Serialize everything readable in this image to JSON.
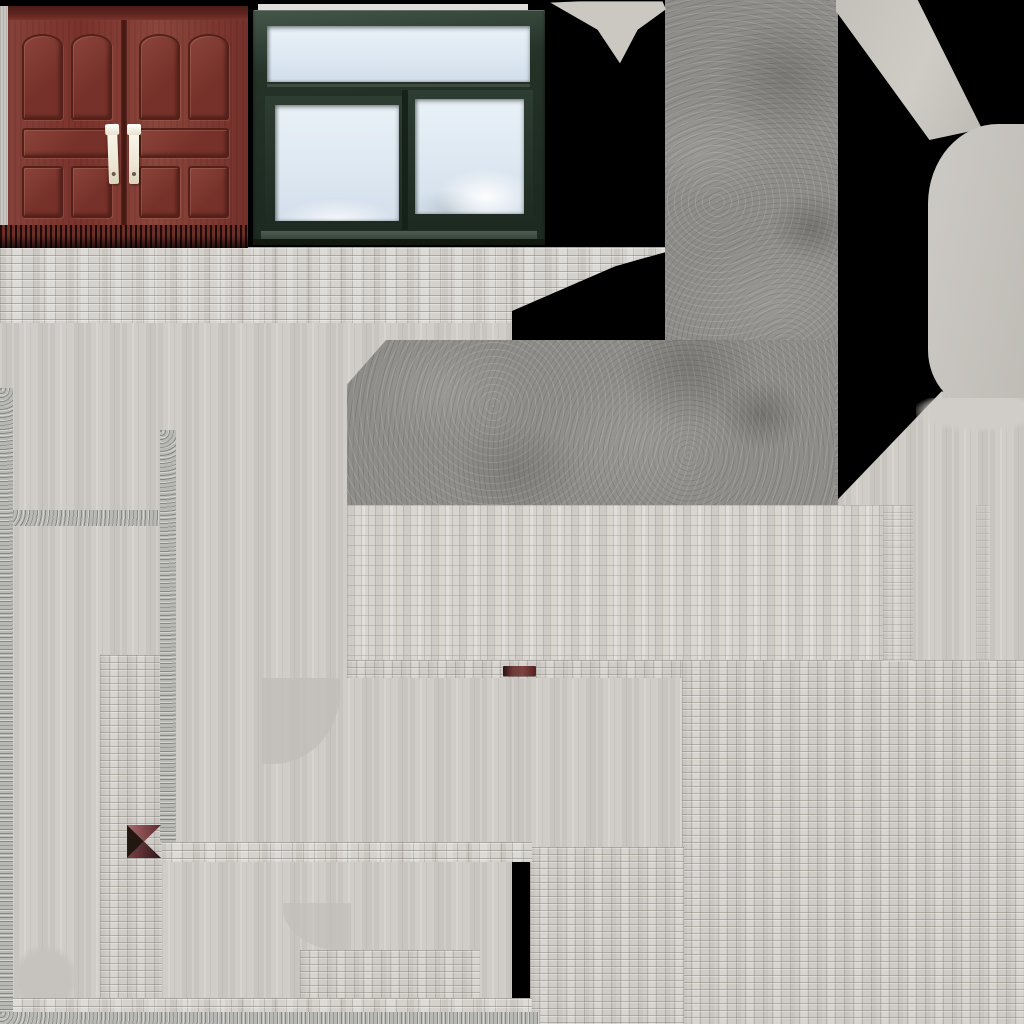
{
  "atlas_kind": "building texture atlas",
  "palette": {
    "background_black": "#000000",
    "brick_light": "#d5d2cd",
    "brick_mortar": "#b2aea9",
    "filler_gray": "#cdcac5",
    "concrete_gray": "#8f8d89",
    "speckle_gray": "#b8b8b4",
    "door_red_brown": "#7a332c",
    "door_groove_dark": "#54201a",
    "handle_cream": "#f2eee4",
    "window_frame_green": "#243227",
    "sky_blue_white": "#dde8f2",
    "accent_dark_red": "#6e3a38",
    "rounded_filler_gray": "#c7c4be"
  },
  "regions": {
    "door": {
      "label": "wooden double door"
    },
    "window": {
      "label": "green frame sliding window with sky"
    },
    "concrete_column": {
      "label": "concrete texture column"
    },
    "concrete_bar": {
      "label": "concrete texture bar"
    },
    "brick_top": {
      "label": "brick wall strip"
    },
    "brick_mid": {
      "label": "brick wall block"
    },
    "brick_bottom": {
      "label": "brick wall field"
    },
    "brick_pillar": {
      "label": "brick pillar strip"
    },
    "filler": {
      "label": "stretched pixel filler"
    },
    "blob": {
      "label": "rounded gray filler"
    },
    "red_dash": {
      "label": "dark red fragment"
    },
    "pinwheel": {
      "label": "red black triangle fragment"
    },
    "speckle": {
      "label": "speckled concrete line"
    },
    "bottom_edge": {
      "label": "bottom edge band"
    }
  }
}
